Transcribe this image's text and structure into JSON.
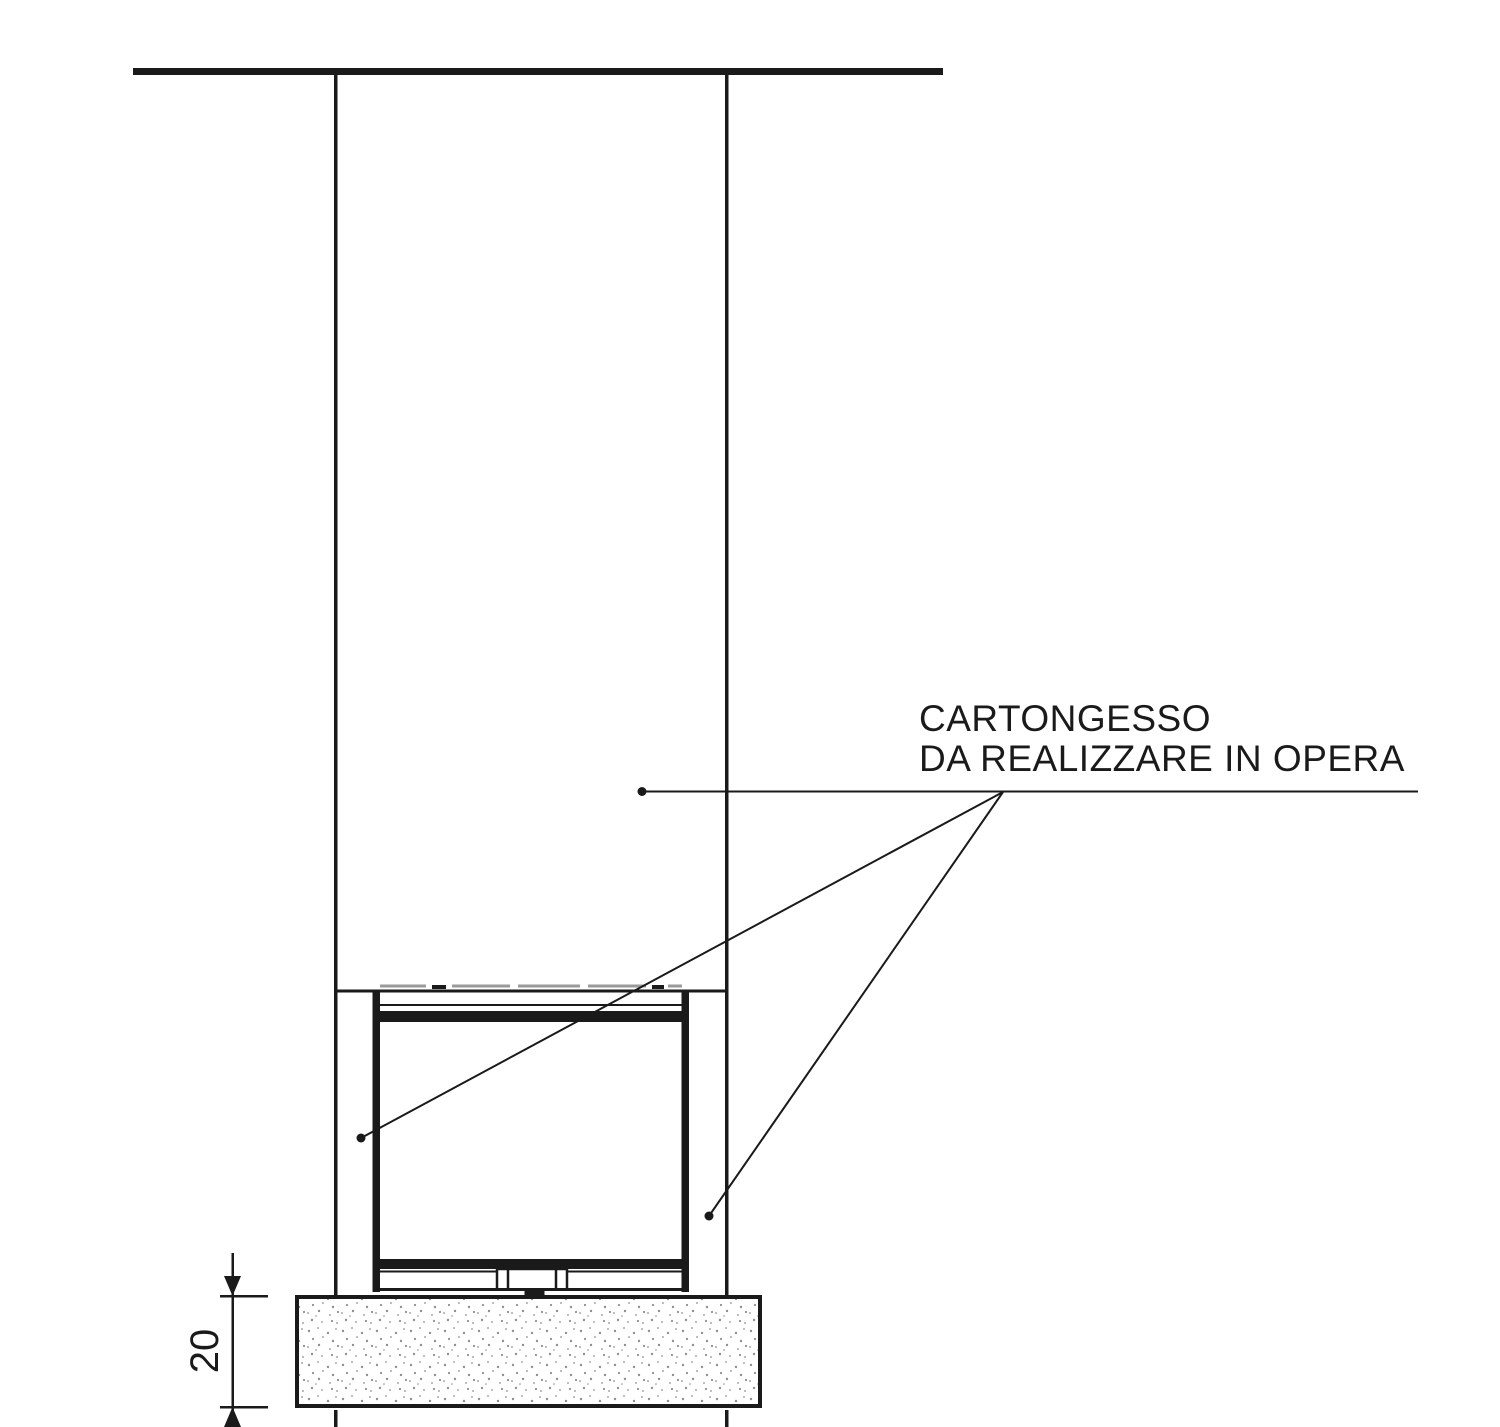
{
  "annotation": {
    "line1": "CARTONGESSO",
    "line2": "DA REALIZZARE IN OPERA"
  },
  "dimension": {
    "value": "20"
  },
  "colors": {
    "line": "#1a1a1a",
    "bg": "#ffffff",
    "gray": "#9a9a9a",
    "stipple": "#8f8f8f"
  }
}
